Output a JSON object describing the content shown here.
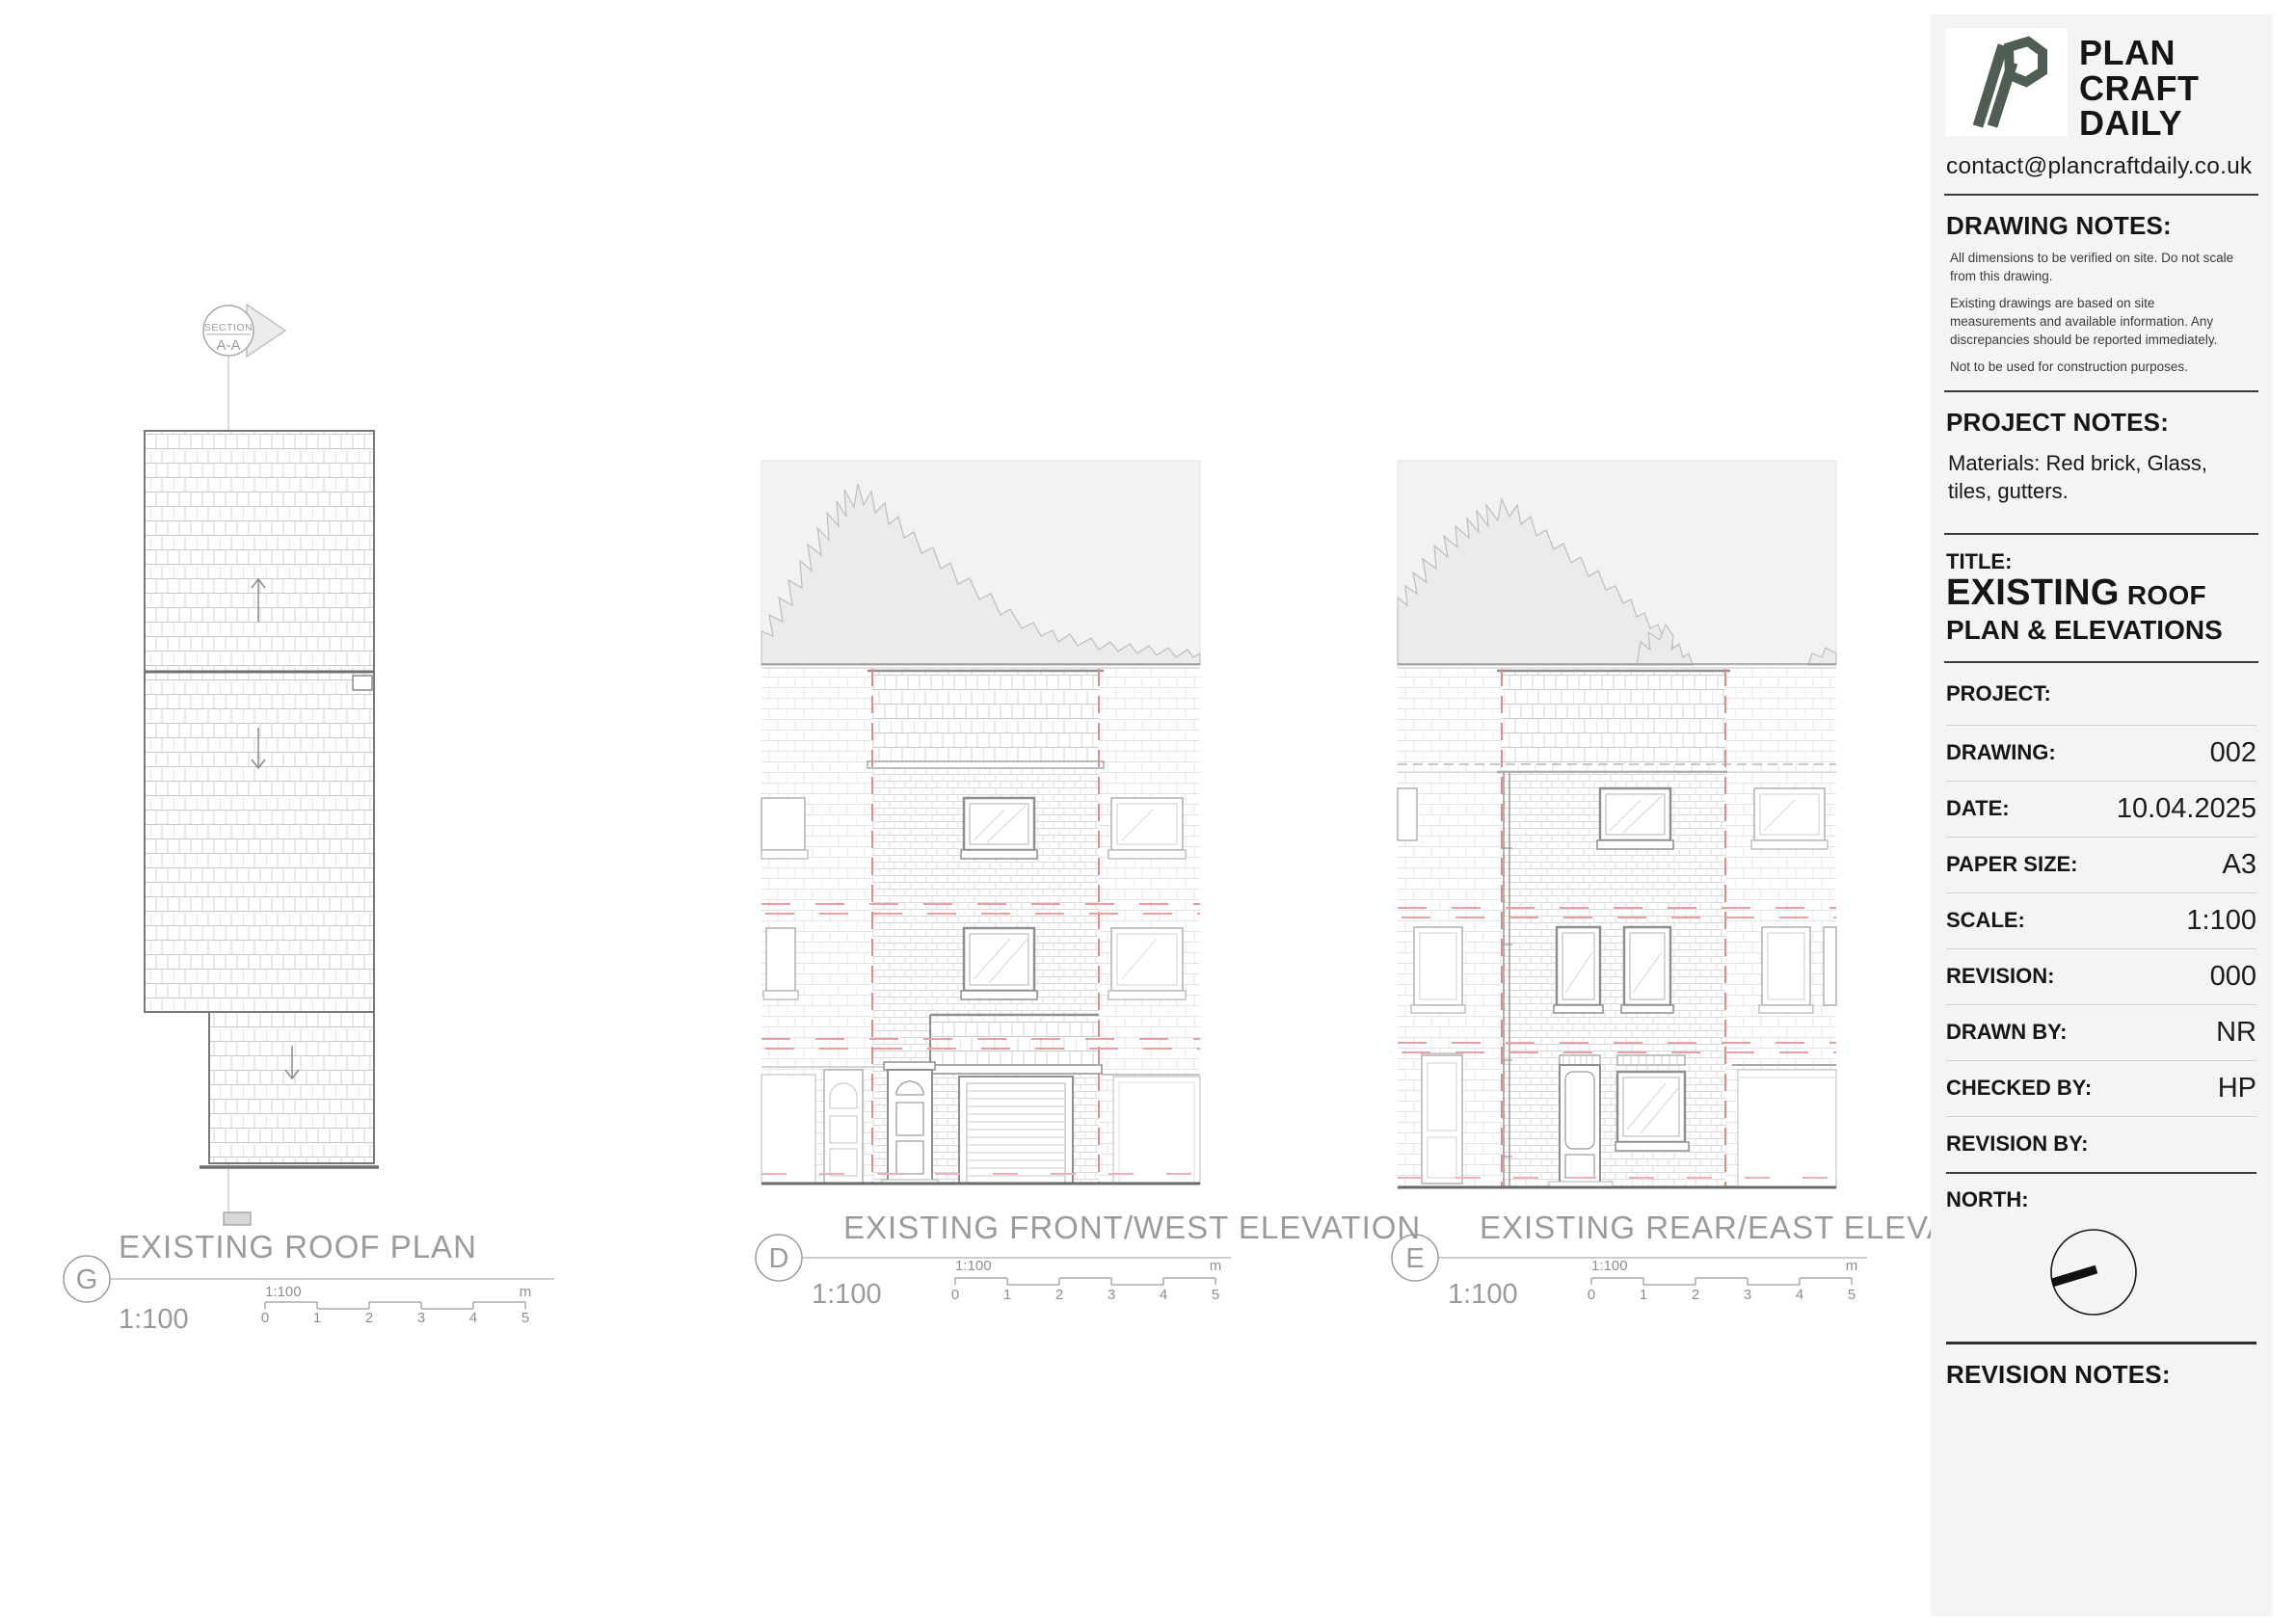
{
  "company": {
    "name_lines": [
      "PLAN",
      "CRAFT",
      "DAILY"
    ],
    "email": "contact@plancraftdaily.co.uk",
    "logo_color": "#4e5f51"
  },
  "drawing_notes": {
    "heading": "DRAWING NOTES:",
    "notes": [
      "All dimensions to be verified on site. Do not scale from this drawing.",
      "Existing drawings are based on site measurements and available information. Any discrepancies should be reported immediately.",
      "Not to be used for construction purposes."
    ]
  },
  "project_notes": {
    "heading": "PROJECT NOTES:",
    "text": "Materials: Red brick, Glass, tiles, gutters."
  },
  "title_block": {
    "label": "TITLE:",
    "line1_strong": "EXISTING",
    "line1_rest": " ROOF",
    "line2": "PLAN & ELEVATIONS"
  },
  "fields": {
    "project": {
      "label": "PROJECT:",
      "value": ""
    },
    "drawing": {
      "label": "DRAWING:",
      "value": "002"
    },
    "date": {
      "label": "DATE:",
      "value": "10.04.2025"
    },
    "paper_size": {
      "label": "PAPER SIZE:",
      "value": "A3"
    },
    "scale": {
      "label": "SCALE:",
      "value": "1:100"
    },
    "revision": {
      "label": "REVISION:",
      "value": "000"
    },
    "drawn_by": {
      "label": "DRAWN BY:",
      "value": "NR"
    },
    "checked_by": {
      "label": "CHECKED BY:",
      "value": "HP"
    },
    "revision_by": {
      "label": "REVISION BY:",
      "value": ""
    }
  },
  "north": {
    "label": "NORTH:"
  },
  "revision_notes": {
    "heading": "REVISION NOTES:"
  },
  "drawings": {
    "roof_plan": {
      "ref": "G",
      "title": "EXISTING ROOF PLAN",
      "scale": "1:100"
    },
    "front_elevation": {
      "ref": "D",
      "title": "EXISTING FRONT/WEST ELEVATION",
      "scale": "1:100"
    },
    "rear_elevation": {
      "ref": "E",
      "title": "EXISTING REAR/EAST ELEVATION",
      "scale": "1:100"
    }
  },
  "section_marker": {
    "line1": "SECTION",
    "line2": "A-A"
  },
  "scale_bar": {
    "label": "1:100",
    "ticks": [
      "0",
      "1",
      "2",
      "3",
      "4",
      "5"
    ],
    "unit": "m"
  },
  "colors": {
    "sheet": "#ffffff",
    "panel": "#f4f4f2",
    "drawing_line": "#9b9b99",
    "hatch_light": "#e0e0de",
    "hatch_tile": "#c9c9c7",
    "dashed_red": "#e59090",
    "sky_fill": "#f2f2f0",
    "tree_fill": "#ebebe9",
    "logo_green": "#4e5f51"
  }
}
